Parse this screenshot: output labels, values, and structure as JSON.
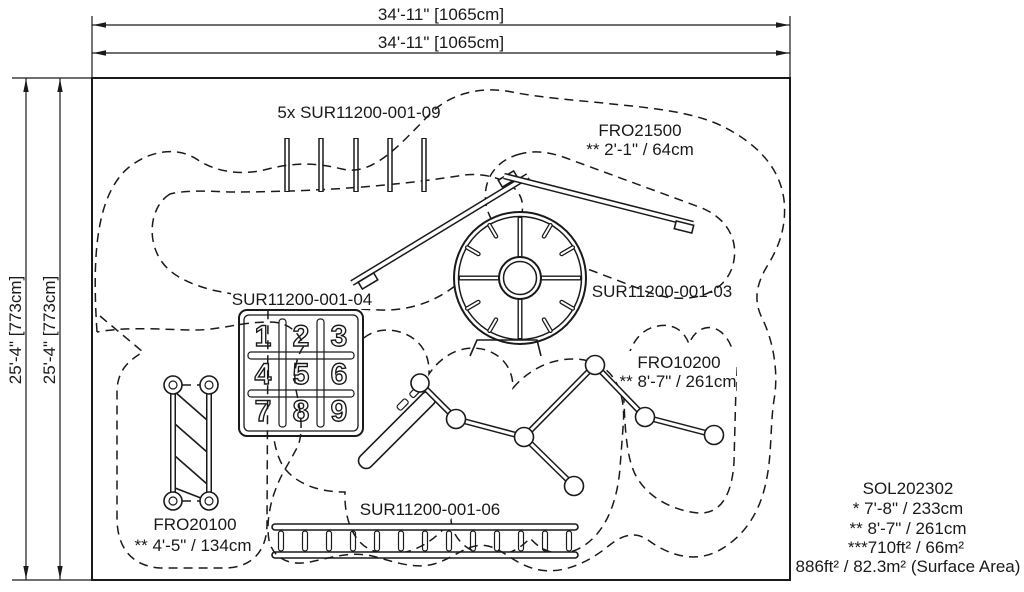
{
  "drawing": {
    "title_block": {
      "model": "SOL202302",
      "line1": "* 7'-8\" / 233cm",
      "line2": "** 8'-7\" / 261cm",
      "line3": "***710ft² / 66m²",
      "line4": "886ft² / 82.3m² (Surface Area)"
    },
    "dimensions": {
      "top": "34'-11\" [1065cm]",
      "left": "25'-4\" [773cm]"
    },
    "labels": {
      "posts": "5x SUR11200-001-09",
      "fro21500": "FRO21500",
      "fro21500_dim": "** 2'-1\" / 64cm",
      "panel": "SUR11200-001-04",
      "spinner": "SUR11200-001-03",
      "fro10200": "FRO10200",
      "fro10200_dim": "** 8'-7\" / 261cm",
      "fro20100": "FRO20100",
      "fro20100_dim": "** 4'-5\" / 134cm",
      "ladder": "SUR11200-001-06"
    },
    "panel_numbers": [
      "1",
      "2",
      "3",
      "4",
      "5",
      "6",
      "7",
      "8",
      "9"
    ],
    "colors": {
      "line": "#1a1a1a",
      "background": "#ffffff"
    }
  }
}
